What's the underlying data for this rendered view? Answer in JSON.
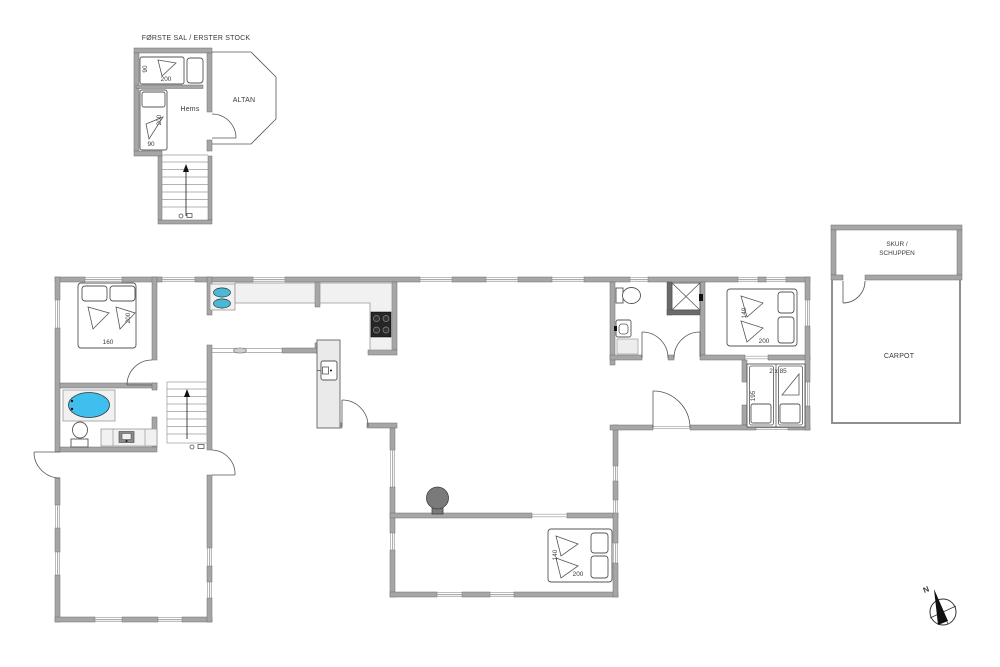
{
  "title": "FØRSTE SAL / ERSTER STOCK",
  "first_floor": {
    "room_label": "Hems",
    "balcony_label": "ALTAN",
    "bed_top": {
      "width": "90",
      "length": "200"
    },
    "bed_left": {
      "length": "200",
      "width": "90"
    }
  },
  "ground_floor": {
    "bedroom_west": {
      "length": "200",
      "width": "160"
    },
    "bedroom_east": {
      "width": "140",
      "length": "200"
    },
    "bedroom_south": {
      "width": "140",
      "length": "200"
    },
    "bunk_room": {
      "beds": "2 x 85",
      "length": "195"
    }
  },
  "outbuilding": {
    "shed_label_line1": "SKUR /",
    "shed_label_line2": "SCHUPPEN",
    "carport_label": "CARPOT"
  },
  "compass": {
    "north": "N"
  },
  "colors": {
    "wall": "#a6a6a6",
    "wall_edge": "#6f6f6f",
    "spa": "#3fbfee",
    "sink": "#49b9d6",
    "cooktop": "#262626",
    "wood_stove": "#7a7a7a",
    "shower_wall": "#6a6a6a"
  }
}
